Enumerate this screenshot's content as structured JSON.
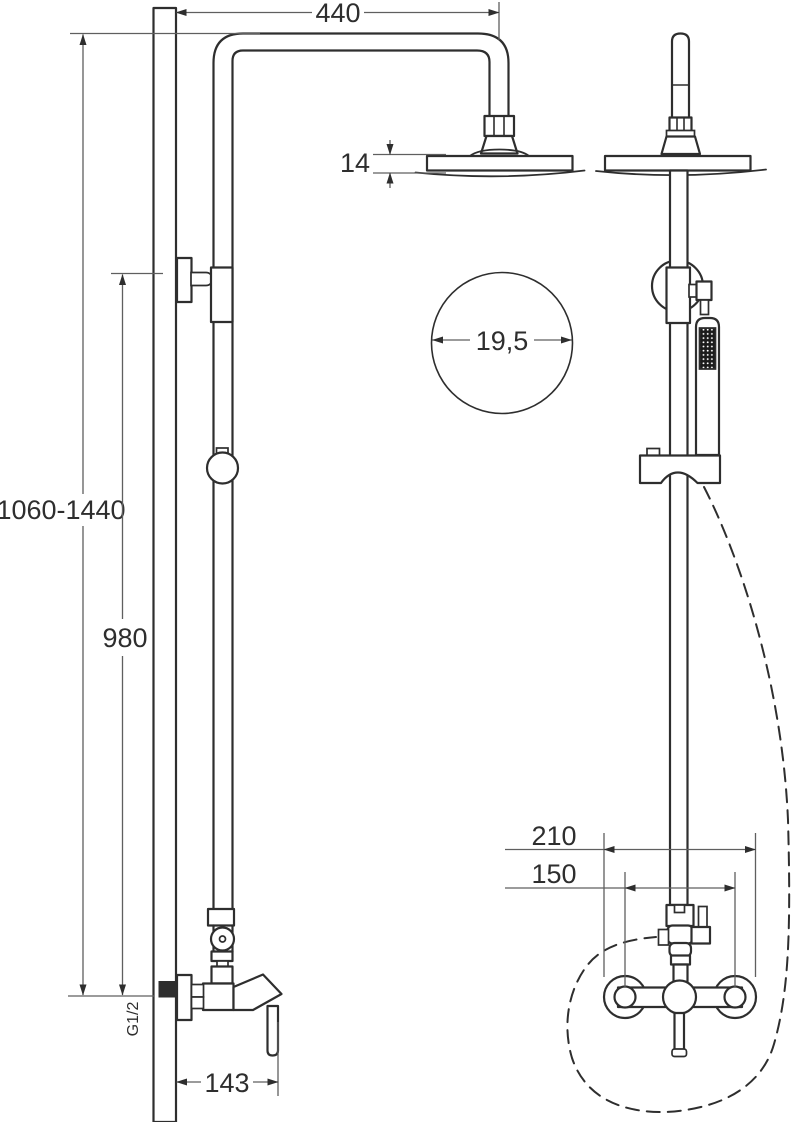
{
  "meta": {
    "description": "Installation drawing of a wall-mounted shower column with overhead rain shower, hand shower on slide bar and single-lever mixer; side view (left) and front view (right) with dimensions in mm",
    "width": 792,
    "height": 1122
  },
  "labels": {
    "arm_projection": "440",
    "head_thickness": "14",
    "head_diameter": "19,5",
    "height_range": "1060-1440",
    "column_height": "980",
    "thread": "G1/2",
    "mixer_projection": "143",
    "overall_width": "210",
    "center_distance": "150"
  },
  "colors": {
    "background": "#ffffff",
    "outline": "#2e2e2e",
    "dimension_line": "#5f5f5f",
    "text": "#2e2e2e",
    "inlet_fill": "#2e2e2e"
  }
}
